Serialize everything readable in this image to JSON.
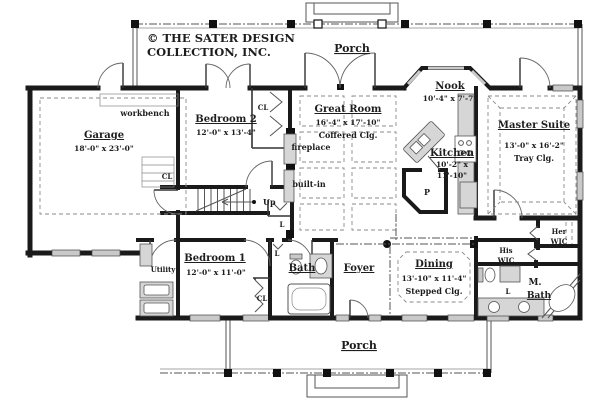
{
  "copyright": {
    "line1": "© THE SATER DESIGN",
    "line2": "COLLECTION, INC."
  },
  "rooms": {
    "porch_top": {
      "name": "Porch"
    },
    "porch_bottom": {
      "name": "Porch"
    },
    "nook": {
      "name": "Nook",
      "dims": "10'-4\" x 7'-7\""
    },
    "garage": {
      "name": "Garage",
      "dims": "18'-0\" x 23'-0\""
    },
    "bedroom2": {
      "name": "Bedroom 2",
      "dims": "12'-0\" x 13'-4\""
    },
    "great_room": {
      "name": "Great Room",
      "dims": "16'-4\" x 17'-10\"",
      "ceiling": "Coffered Clg."
    },
    "master_suite": {
      "name": "Master Suite",
      "dims": "13'-0\" x 16'-2\"",
      "ceiling": "Tray Clg."
    },
    "kitchen": {
      "name": "Kitchen",
      "dims_line1": "10'-2\" x",
      "dims_line2": "11'-10\""
    },
    "utility": {
      "name": "Utility"
    },
    "bedroom1": {
      "name": "Bedroom 1",
      "dims": "12'-0\" x 11'-0\""
    },
    "bath": {
      "name": "Bath"
    },
    "foyer": {
      "name": "Foyer"
    },
    "dining": {
      "name": "Dining",
      "dims": "13'-10\" x 11'-4\"",
      "ceiling": "Stepped Clg."
    },
    "his_wic": {
      "line1": "His",
      "line2": "WIC"
    },
    "her_wic": {
      "line1": "Her",
      "line2": "WIC"
    },
    "m_bath": {
      "line1": "M.",
      "line2": "Bath"
    }
  },
  "annotations": {
    "workbench": "workbench",
    "fireplace": "fireplace",
    "built_in": "built-in",
    "up": "Up",
    "pantry": "P",
    "closet": "CL",
    "linen": "L"
  },
  "colors": {
    "wall": "#1a1a1a",
    "fixture": "#d6d6d6",
    "window": "#c9c9c9",
    "dashed_ceiling": "#8a8a8a",
    "text": "#1d1d1d",
    "background": "#ffffff"
  }
}
